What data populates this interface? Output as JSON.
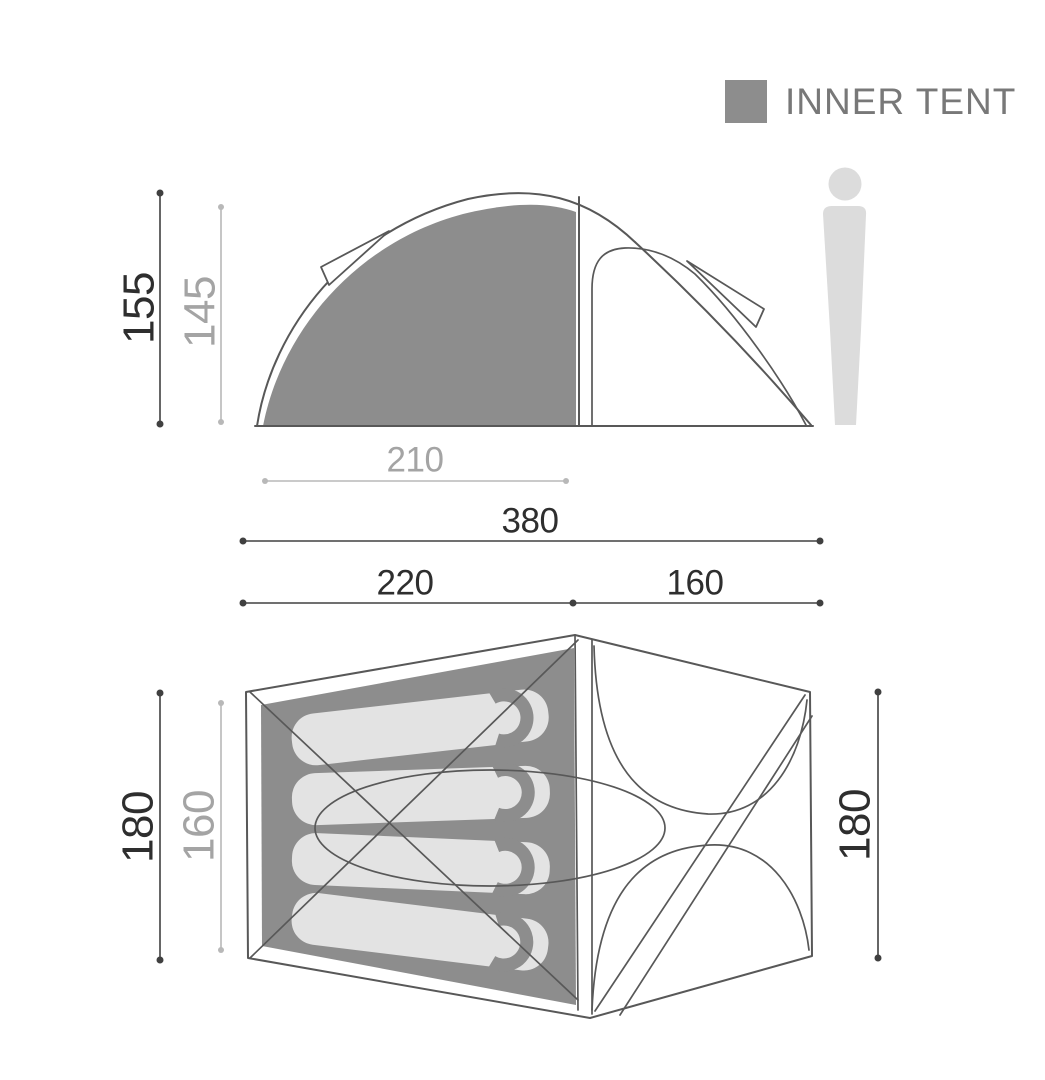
{
  "legend": {
    "label": "INNER TENT",
    "swatch_color": "#8d8d8d"
  },
  "side_view": {
    "outer_height": "155",
    "inner_height": "145",
    "inner_width": "210",
    "total_width": "380",
    "inner_section_width": "220",
    "vestibule_width": "160"
  },
  "floor_plan": {
    "outer_depth_left": "180",
    "inner_depth": "160",
    "outer_depth_right": "180",
    "sleeping_bag_count": 4
  },
  "colors": {
    "inner_tent_gray": "#8d8d8d",
    "bag_gray": "#e3e3e3",
    "person_gray": "#dcdcdc",
    "outline": "#585858",
    "dim_dark_line": "#404040",
    "dim_dark_text": "#2e2e2e",
    "dim_gray_line": "#b8b8b8",
    "dim_gray_text": "#a4a4a4",
    "legend_text": "#787878"
  }
}
